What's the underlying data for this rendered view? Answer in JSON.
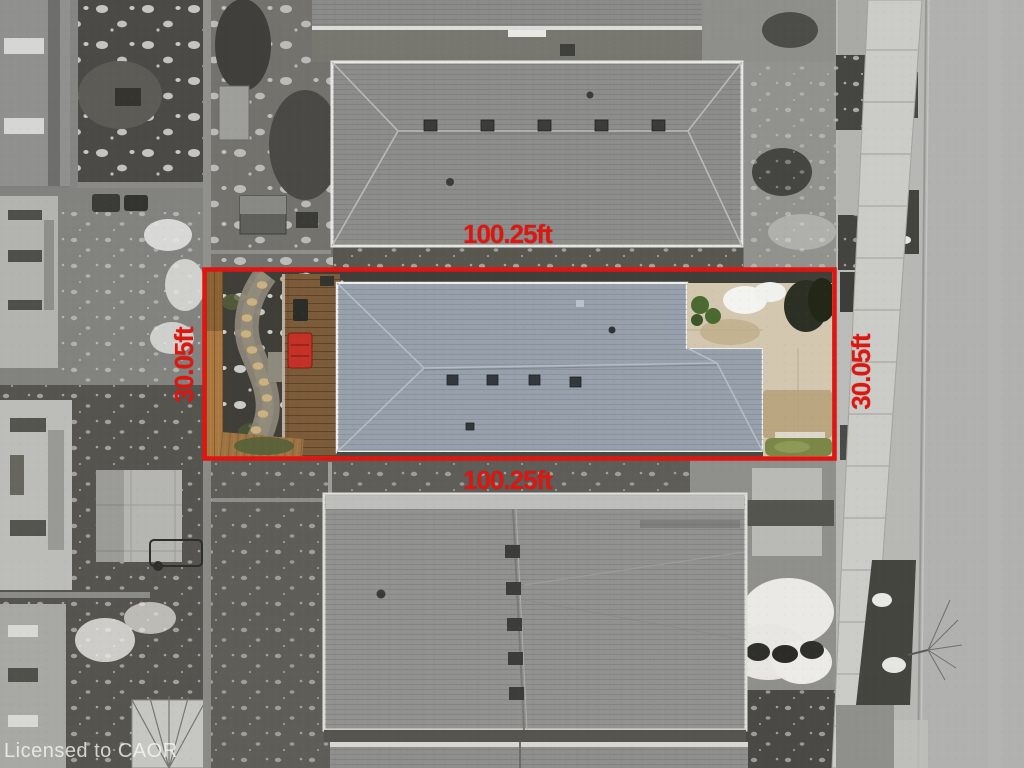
{
  "image": {
    "description": "aerial-drone-photo-of-subject-lot-with-boundary-overlay",
    "watermark": "Licensed to CAOR"
  },
  "annotations": {
    "frontage_top": "100.25ft",
    "frontage_bottom": "100.25ft",
    "depth_left": "30.05ft",
    "depth_right": "30.05ft"
  },
  "colors": {
    "boundary_red": "#e01511",
    "label_red": "#df160f",
    "subject_roof_blue_gray": "#98a1ab",
    "deck_wood_brown": "#7b5b3a",
    "fence_wood_tan": "#a87840",
    "grass_green": "#7b8747",
    "street_gray": "#b1b1af",
    "watermark_white": "#f7f7f4"
  }
}
